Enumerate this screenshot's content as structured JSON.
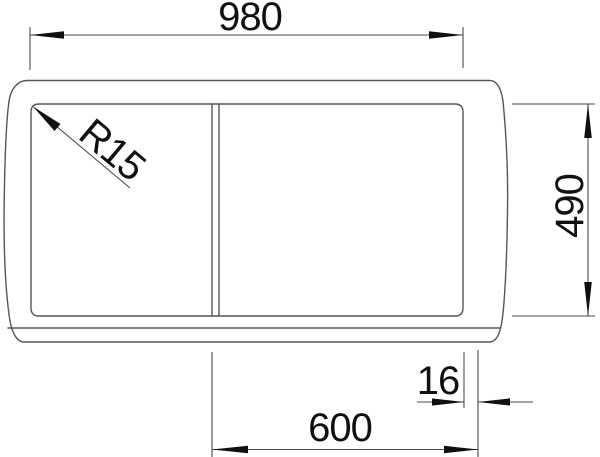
{
  "drawing": {
    "type": "technical-dimension-drawing",
    "subject": "sink-top-view",
    "labels": {
      "width": "980",
      "depth": "490",
      "corner_radius": "R15",
      "edge_offset": "16",
      "cabinet_width": "600"
    },
    "colors": {
      "outline": "#565656",
      "dimension_line": "#4a4a4a",
      "text": "#101010",
      "background": "#ffffff"
    }
  }
}
